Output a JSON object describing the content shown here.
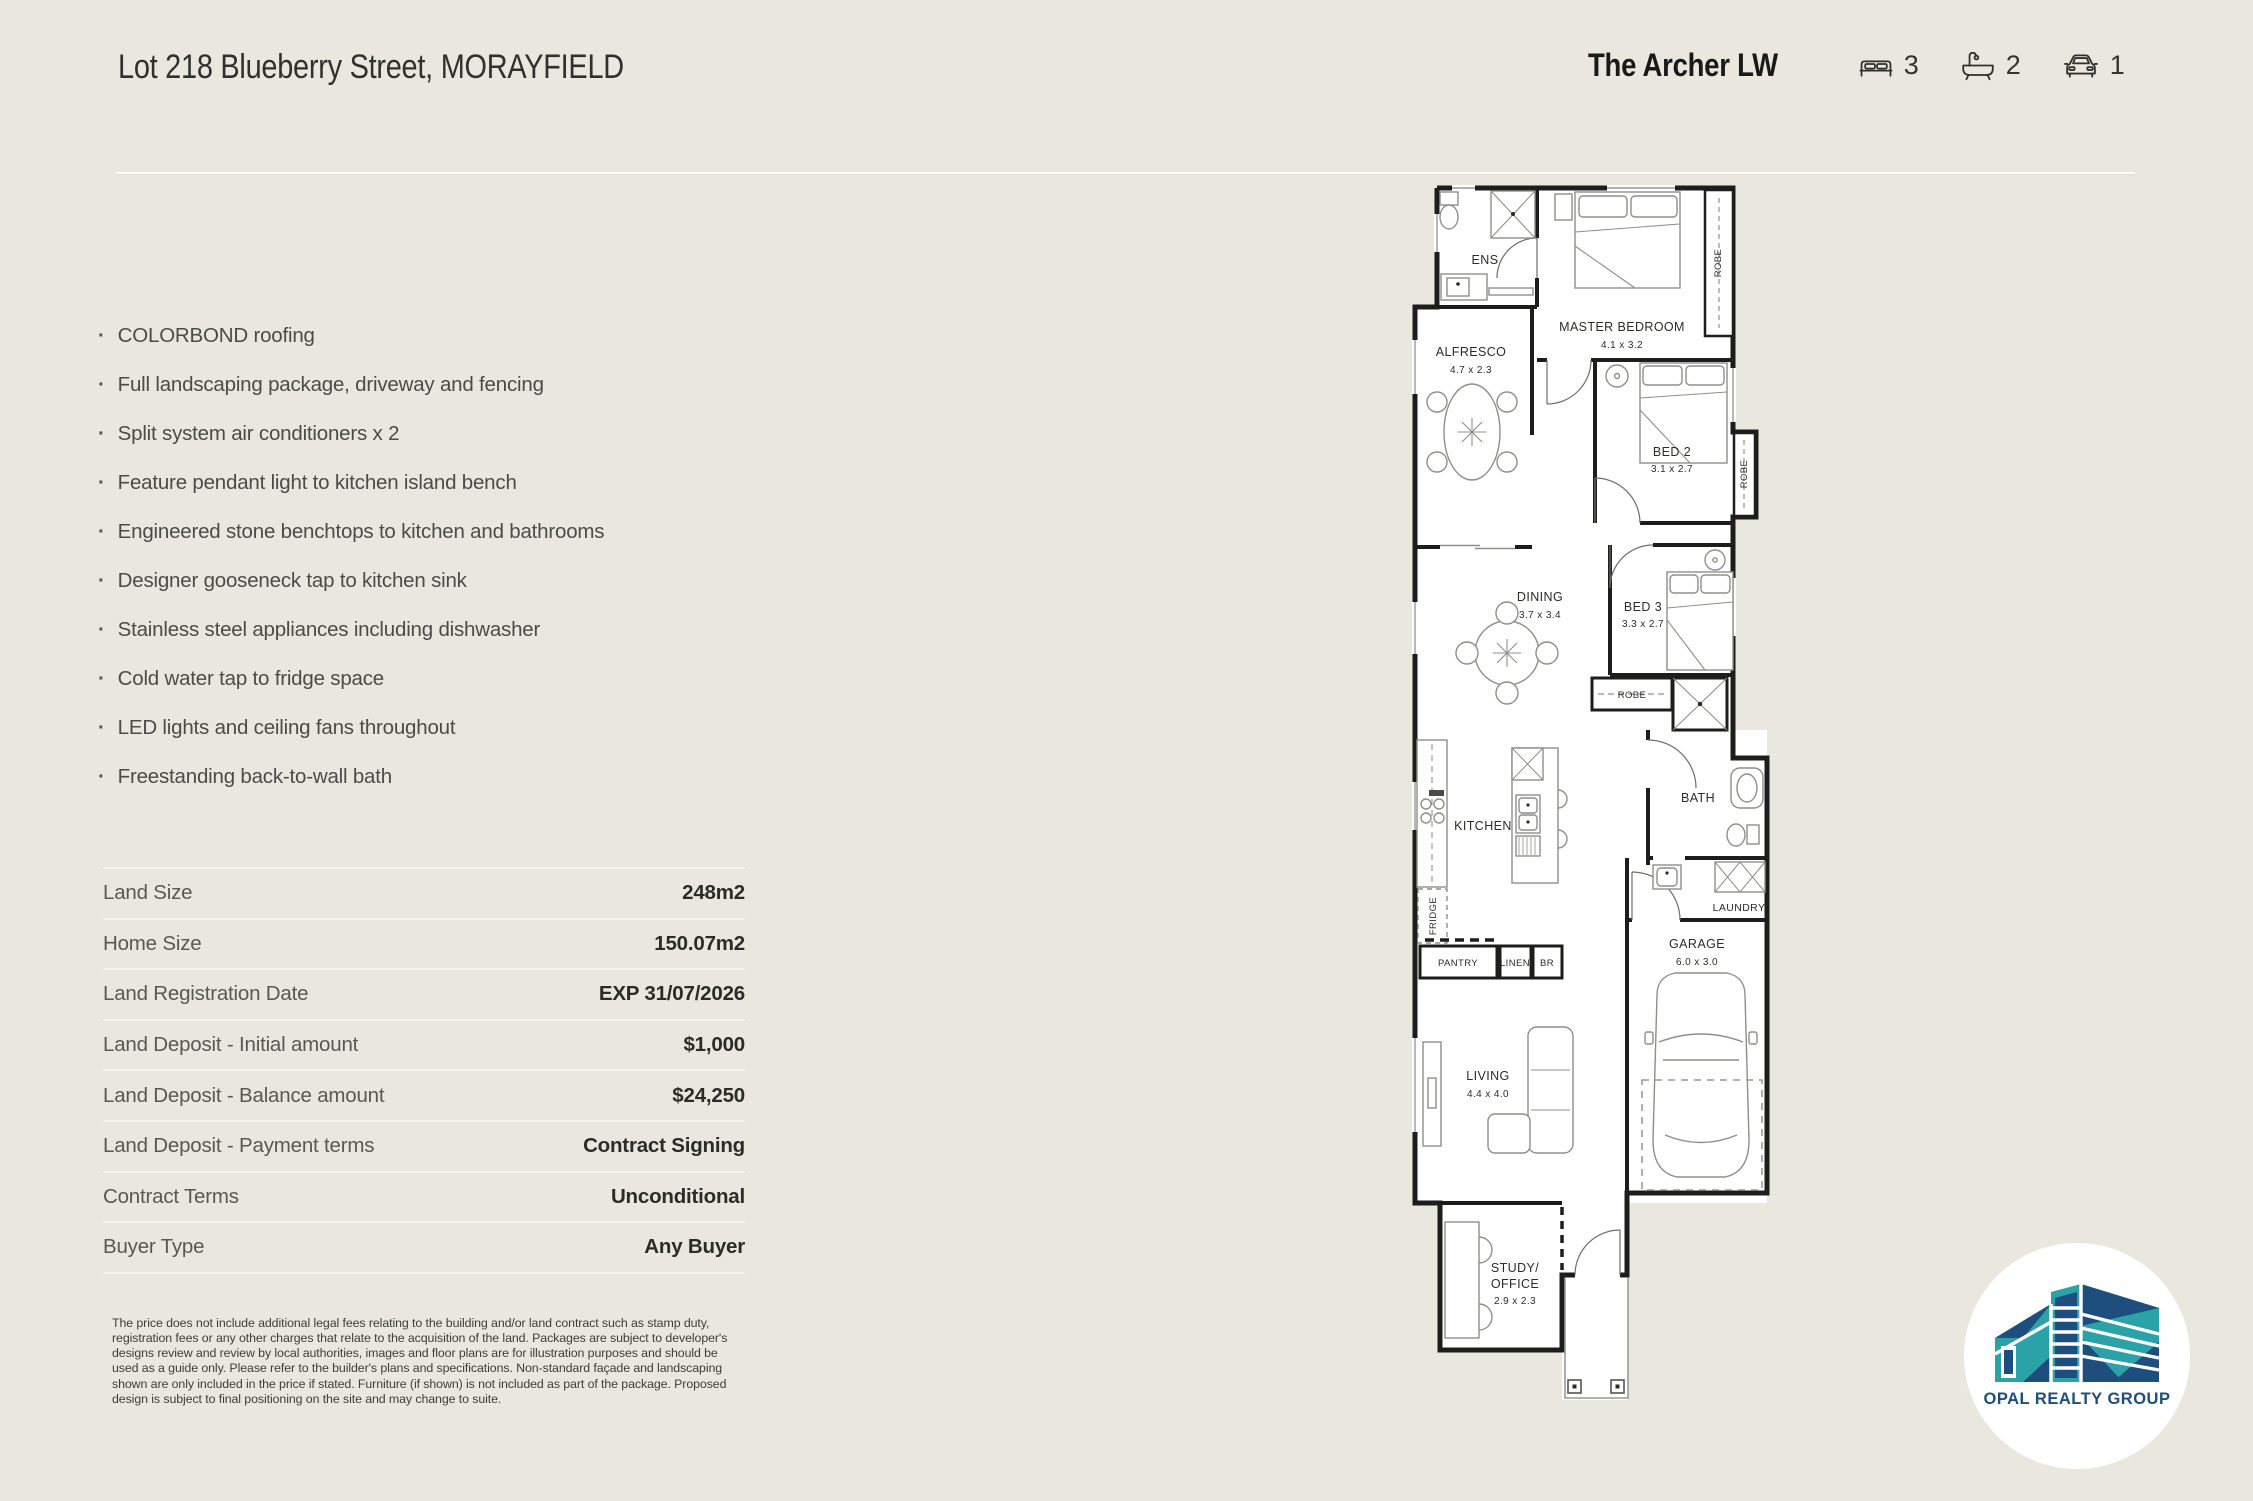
{
  "header": {
    "address": "Lot 218 Blueberry Street, MORAYFIELD",
    "plan_name": "The Archer LW",
    "stats": {
      "beds": "3",
      "baths": "2",
      "cars": "1"
    }
  },
  "features": {
    "items": [
      "COLORBOND roofing",
      "Full landscaping package, driveway and fencing",
      "Split system air conditioners x 2",
      "Feature pendant light to kitchen island bench",
      "Engineered stone benchtops to kitchen and bathrooms",
      "Designer gooseneck tap to kitchen sink",
      "Stainless steel appliances including dishwasher",
      "Cold water tap to fridge space",
      "LED lights and ceiling fans throughout",
      "Freestanding back-to-wall bath"
    ]
  },
  "details": {
    "rows": [
      {
        "label": "Land Size",
        "value": "248m2"
      },
      {
        "label": "Home Size",
        "value": "150.07m2"
      },
      {
        "label": "Land Registration Date",
        "value": "EXP 31/07/2026"
      },
      {
        "label": "Land Deposit - Initial amount",
        "value": "$1,000"
      },
      {
        "label": "Land Deposit - Balance amount",
        "value": "$24,250"
      },
      {
        "label": "Land Deposit - Payment terms",
        "value": "Contract Signing"
      },
      {
        "label": "Contract Terms",
        "value": "Unconditional"
      },
      {
        "label": "Buyer Type",
        "value": "Any Buyer"
      }
    ]
  },
  "disclaimer": "The price does not include additional legal fees relating to the building and/or land contract such as stamp duty, registration fees or any other charges that relate to the acquisition of the land. Packages are subject to developer's designs review and review by local authorities, images and floor plans are for illustration purposes and should be used as a guide only. Please refer to the builder's plans and specifications. Non-standard façade and landscaping shown are only included in the price if stated. Furniture (if shown) is not included as part of the package. Proposed design is subject to final positioning on the site and may change to suite.",
  "floorplan": {
    "rooms": {
      "ens": {
        "name": "ENS"
      },
      "master": {
        "name": "MASTER BEDROOM",
        "dims": "4.1 x 3.2"
      },
      "robe_master": {
        "name": "ROBE"
      },
      "robe_bed2": {
        "name": "ROBE"
      },
      "robe_hall": {
        "name": "ROBE"
      },
      "alfresco": {
        "name": "ALFRESCO",
        "dims": "4.7 x 2.3"
      },
      "bed2": {
        "name": "BED 2",
        "dims": "3.1 x 2.7"
      },
      "bed3": {
        "name": "BED 3",
        "dims": "3.3 x 2.7"
      },
      "dining": {
        "name": "DINING",
        "dims": "3.7 x 3.4"
      },
      "bath": {
        "name": "BATH"
      },
      "kitchen": {
        "name": "KITCHEN"
      },
      "fridge": {
        "name": "FRIDGE"
      },
      "pantry": {
        "name": "PANTRY"
      },
      "linen": {
        "name": "LINEN"
      },
      "br": {
        "name": "BR"
      },
      "laundry": {
        "name": "LAUNDRY"
      },
      "garage": {
        "name": "GARAGE",
        "dims": "6.0 x 3.0"
      },
      "living": {
        "name": "LIVING",
        "dims": "4.4 x 4.0"
      },
      "study": {
        "line1": "STUDY/",
        "line2": "OFFICE",
        "dims": "2.9 x 2.3"
      }
    }
  },
  "logo": {
    "text": "OPAL REALTY GROUP",
    "teal": "#2BA2A8",
    "navy": "#1D4E7E"
  }
}
